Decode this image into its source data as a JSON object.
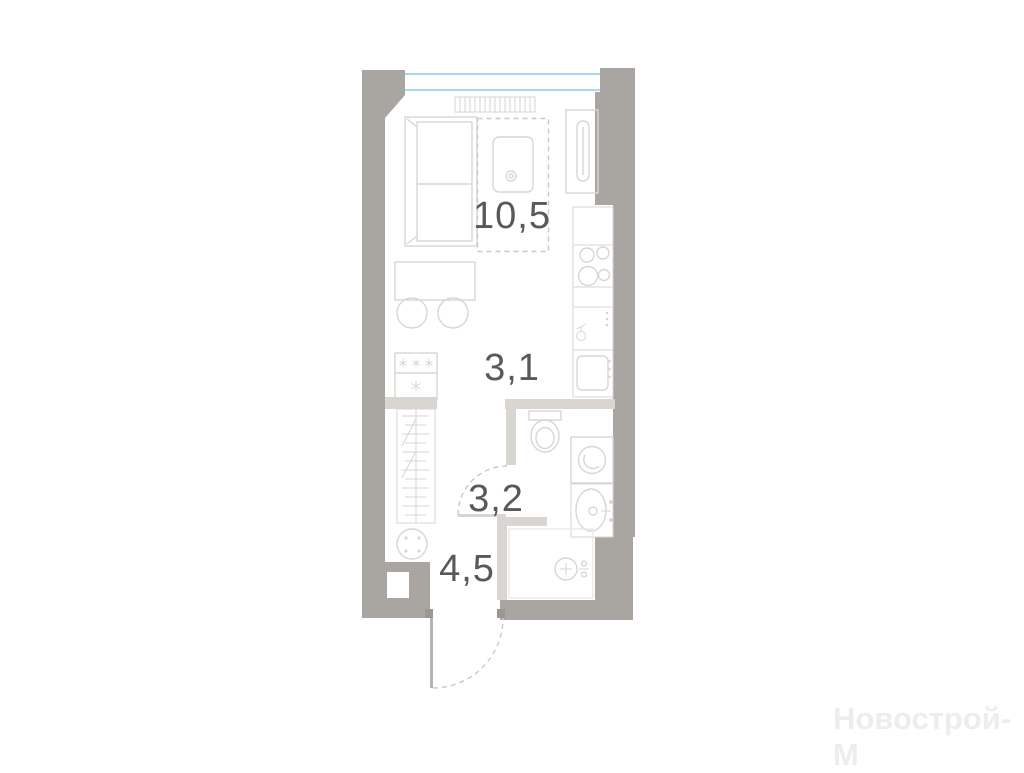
{
  "plan": {
    "type": "studio-apartment-floor-plan",
    "rooms": {
      "living": {
        "name": "living-kitchen-room",
        "area": "10,5"
      },
      "corridor": {
        "name": "kitchen-corridor",
        "area": "3,1"
      },
      "bathroom": {
        "name": "bathroom",
        "area": "3,2"
      },
      "hallway": {
        "name": "entry-hallway",
        "area": "4,5"
      }
    },
    "icons": {
      "bed": "bed-icon",
      "wardrobe": "wardrobe-hangers-icon",
      "freezer_stars": "freezer-snowflakes-icon",
      "table": "dining-table-icon",
      "stools": "stool-icon",
      "hob": "four-burner-hob-icon",
      "kitchen_sink": "kitchen-sink-icon",
      "tall_cabinet": "tall-cabinet-fridge-icon",
      "toilet": "toilet-icon",
      "washing_machine": "washing-machine-icon",
      "bath_sink": "washbasin-icon",
      "shower": "shower-mixer-icon",
      "radiator": "radiator-icon",
      "entry_door": "entry-door-swing-icon",
      "bathroom_door": "bathroom-door-swing-icon",
      "window": "window-glazing-icon"
    }
  },
  "watermark": {
    "text": "Новострой-М"
  },
  "colors": {
    "wall": "#a9a5a1",
    "partition": "#d9d5d0",
    "furniture-line": "#d9d6d2",
    "window-glass": "#a6d9e9",
    "label": "#58595c",
    "watermark": "#eeedec",
    "jamb": "#9b9792",
    "door-leaf": "#b7b4b0",
    "door-arc": "#cbc8c4"
  }
}
